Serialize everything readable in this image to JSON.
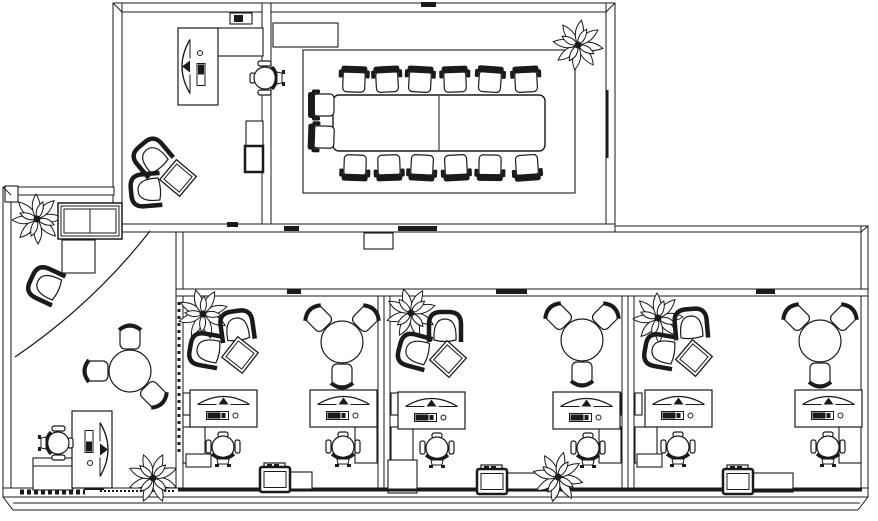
{
  "canvas": {
    "width": 878,
    "height": 521,
    "background": "#ffffff",
    "line_color": "#1a1a1a"
  },
  "floorplan": {
    "walls": [
      {
        "name": "top-wall",
        "x": 113,
        "y": 3,
        "w": 502,
        "h": 9
      },
      {
        "name": "private-office-left-wall",
        "x": 113,
        "y": 3,
        "w": 9,
        "h": 229
      },
      {
        "name": "office-conference-divider-wall",
        "x": 262,
        "y": 3,
        "w": 9,
        "h": 229
      },
      {
        "name": "conference-right-wall",
        "x": 606,
        "y": 3,
        "w": 9,
        "h": 229
      },
      {
        "name": "corridor-top-wall-left",
        "x": 121,
        "y": 224,
        "w": 494,
        "h": 8
      },
      {
        "name": "reception-top-wall",
        "x": 3,
        "y": 187,
        "w": 111,
        "h": 8
      },
      {
        "name": "reception-left-wall",
        "x": 3,
        "y": 187,
        "w": 8,
        "h": 310
      },
      {
        "name": "reception-right-wall",
        "x": 176,
        "y": 232,
        "w": 7,
        "h": 265
      },
      {
        "name": "corridor-top-wall-right",
        "x": 615,
        "y": 226,
        "w": 253,
        "h": 6
      },
      {
        "name": "building-right-wall",
        "x": 861,
        "y": 226,
        "w": 7,
        "h": 271
      },
      {
        "name": "workbay-top-wall",
        "x": 176,
        "y": 289,
        "w": 692,
        "h": 7
      },
      {
        "name": "workbay-divider-wall-1",
        "x": 378,
        "y": 296,
        "w": 12,
        "h": 192
      },
      {
        "name": "workbay-divider-wall-2",
        "x": 622,
        "y": 296,
        "w": 12,
        "h": 192
      },
      {
        "name": "building-bottom-wall",
        "x": 3,
        "y": 488,
        "w": 865,
        "h": 9
      }
    ],
    "wall_lines": [
      {
        "name": "miter-top-left",
        "x1": 113,
        "y1": 3,
        "x2": 122,
        "y2": 12
      },
      {
        "name": "miter-conference-top-right",
        "x1": 615,
        "y1": 3,
        "x2": 606,
        "y2": 12
      },
      {
        "name": "miter-reception-corner",
        "x1": 3,
        "y1": 187,
        "x2": 11,
        "y2": 195
      },
      {
        "name": "miter-corridor-right",
        "x1": 868,
        "y1": 226,
        "x2": 861,
        "y2": 232
      },
      {
        "name": "miter-bottom-left",
        "x1": 3,
        "y1": 497,
        "x2": 13,
        "y2": 510
      },
      {
        "name": "miter-bottom-right",
        "x1": 868,
        "y1": 497,
        "x2": 858,
        "y2": 510
      },
      {
        "name": "apron-line-1",
        "x1": 13,
        "y1": 503,
        "x2": 860,
        "y2": 503
      },
      {
        "name": "apron-line-2",
        "x1": 13,
        "y1": 510,
        "x2": 858,
        "y2": 510
      },
      {
        "name": "divider-1-centerline",
        "x1": 384,
        "y1": 296,
        "x2": 384,
        "y2": 488
      },
      {
        "name": "divider-2-centerline",
        "x1": 628,
        "y1": 296,
        "x2": 628,
        "y2": 488
      },
      {
        "name": "bottom-wall-heavy-edge",
        "x1": 178,
        "y1": 490,
        "x2": 862,
        "y2": 490,
        "w": 3
      },
      {
        "name": "reception-threshold-dashed",
        "x1": 20,
        "y1": 492,
        "x2": 85,
        "y2": 492,
        "w": 5,
        "dash": "4 3"
      },
      {
        "name": "reception-bottom-dotted",
        "x1": 100,
        "y1": 491,
        "x2": 174,
        "y2": 491,
        "w": 2,
        "dash": "2 2"
      },
      {
        "name": "reception-wall-glазing-dash",
        "x1": 179,
        "y1": 302,
        "x2": 179,
        "y2": 455,
        "w": 3,
        "dash": "3 4"
      },
      {
        "name": "conference-window-strip",
        "x1": 607,
        "y1": 90,
        "x2": 607,
        "y2": 158,
        "w": 3
      },
      {
        "name": "conference-table-centerline",
        "x1": 439,
        "y1": 96,
        "x2": 439,
        "y2": 150
      },
      {
        "name": "reception-counter-inner-line",
        "x1": 33,
        "y1": 466,
        "x2": 73,
        "y2": 466
      }
    ],
    "furniture_rects": [
      {
        "name": "conference-room-inner-border",
        "x": 303,
        "y": 50,
        "w": 272,
        "h": 143
      },
      {
        "name": "conference-table",
        "x": 333,
        "y": 95,
        "w": 212,
        "h": 56,
        "rx": 6,
        "sw": 1.4
      },
      {
        "name": "conference-credenza",
        "x": 273,
        "y": 23,
        "w": 65,
        "h": 24
      },
      {
        "name": "office-credenza",
        "x": 217,
        "y": 28,
        "w": 46,
        "h": 28
      },
      {
        "name": "office-phone-tray",
        "x": 230,
        "y": 13,
        "w": 22,
        "h": 11
      },
      {
        "name": "office-file-cabinet-top",
        "x": 246,
        "y": 121,
        "w": 17,
        "h": 25
      },
      {
        "name": "office-file-cabinet-bottom",
        "x": 245,
        "y": 146,
        "w": 18,
        "h": 26,
        "sw": 2.5
      },
      {
        "name": "reception-square-table",
        "x": 62,
        "y": 240,
        "w": 33,
        "h": 33
      },
      {
        "name": "reception-counter",
        "x": 33,
        "y": 458,
        "w": 40,
        "h": 32
      },
      {
        "name": "reception-mini-printer",
        "x": 85,
        "y": 477,
        "w": 18,
        "h": 12,
        "sw": 2
      },
      {
        "name": "corridor-sign",
        "x": 364,
        "y": 233,
        "w": 29,
        "h": 16
      },
      {
        "name": "corner-post",
        "x": 5,
        "y": 186,
        "w": 13,
        "h": 16
      },
      {
        "name": "wall-shelf",
        "x": 183,
        "y": 393,
        "w": 7,
        "h": 22
      },
      {
        "name": "wall-shelf",
        "x": 371,
        "y": 393,
        "w": 7,
        "h": 22
      },
      {
        "name": "wall-shelf",
        "x": 391,
        "y": 393,
        "w": 7,
        "h": 22
      },
      {
        "name": "wall-shelf",
        "x": 614,
        "y": 393,
        "w": 7,
        "h": 22
      },
      {
        "name": "wall-shelf",
        "x": 635,
        "y": 393,
        "w": 7,
        "h": 22
      },
      {
        "name": "wall-shelf",
        "x": 854,
        "y": 393,
        "w": 7,
        "h": 22
      },
      {
        "name": "desk-return",
        "x": 183,
        "y": 427,
        "w": 22,
        "h": 36
      },
      {
        "name": "desk-return",
        "x": 355,
        "y": 427,
        "w": 22,
        "h": 36
      },
      {
        "name": "desk-return",
        "x": 391,
        "y": 427,
        "w": 22,
        "h": 36
      },
      {
        "name": "desk-return",
        "x": 599,
        "y": 427,
        "w": 22,
        "h": 36
      },
      {
        "name": "desk-return",
        "x": 635,
        "y": 427,
        "w": 22,
        "h": 36
      },
      {
        "name": "desk-return",
        "x": 839,
        "y": 427,
        "w": 22,
        "h": 36
      },
      {
        "name": "low-cabinet",
        "x": 186,
        "y": 454,
        "w": 25,
        "h": 13
      },
      {
        "name": "low-cabinet",
        "x": 388,
        "y": 460,
        "w": 29,
        "h": 33
      },
      {
        "name": "low-cabinet",
        "x": 637,
        "y": 454,
        "w": 25,
        "h": 13
      },
      {
        "name": "printer-stand",
        "x": 262,
        "y": 472,
        "w": 50,
        "h": 19
      },
      {
        "name": "printer-stand",
        "x": 479,
        "y": 473,
        "w": 81,
        "h": 18
      },
      {
        "name": "printer-stand",
        "x": 725,
        "y": 473,
        "w": 68,
        "h": 19
      }
    ],
    "dark_marks": [
      {
        "name": "door-threshold",
        "x": 227,
        "y": 222,
        "w": 11,
        "h": 5
      },
      {
        "name": "door-threshold",
        "x": 284,
        "y": 226,
        "w": 15,
        "h": 5
      },
      {
        "name": "door-leaf-conference",
        "x": 398,
        "y": 226,
        "w": 39,
        "h": 5
      },
      {
        "name": "door-threshold-top",
        "x": 421,
        "y": 2,
        "w": 15,
        "h": 5
      },
      {
        "name": "door-leaf-bay-1",
        "x": 287,
        "y": 289,
        "w": 14,
        "h": 5
      },
      {
        "name": "door-leaf-bay-2",
        "x": 496,
        "y": 289,
        "w": 31,
        "h": 5
      },
      {
        "name": "door-leaf-bay-3",
        "x": 756,
        "y": 289,
        "w": 19,
        "h": 5
      },
      {
        "name": "phone-handset",
        "x": 234,
        "y": 15,
        "w": 9,
        "h": 7
      }
    ],
    "paths": [
      {
        "name": "door-swing-arc",
        "d": "M150 231 Q93 304 15 357"
      }
    ],
    "furniture": [
      {
        "name": "plant-conference",
        "type": "plant",
        "cx": 578,
        "cy": 45,
        "rot": 10
      },
      {
        "name": "plant-reception-top",
        "type": "plant",
        "cx": 37,
        "cy": 219,
        "rot": 0
      },
      {
        "name": "plant-reception-bottom",
        "type": "plant",
        "cx": 153,
        "cy": 478,
        "rot": 25
      },
      {
        "name": "plant-bay-1",
        "type": "plant",
        "cx": 203,
        "cy": 314,
        "rot": -15
      },
      {
        "name": "plant-bay-2",
        "type": "plant",
        "cx": 411,
        "cy": 313,
        "rot": 30
      },
      {
        "name": "plant-bay-3",
        "type": "plant",
        "cx": 658,
        "cy": 318,
        "rot": 0
      },
      {
        "name": "plant-bay-2-bottom",
        "type": "plant",
        "cx": 558,
        "cy": 477,
        "rot": 15
      },
      {
        "name": "lounge-armchair",
        "type": "armchair",
        "cx": 152,
        "cy": 157,
        "rot": -40
      },
      {
        "name": "lounge-armchair",
        "type": "armchair",
        "cx": 147,
        "cy": 190,
        "rot": -95
      },
      {
        "name": "lounge-armchair",
        "type": "armchair",
        "cx": 46,
        "cy": 285,
        "rot": -65
      },
      {
        "name": "lounge-armchair",
        "type": "armchair",
        "cx": 237,
        "cy": 327,
        "rot": -8
      },
      {
        "name": "lounge-armchair",
        "type": "armchair",
        "cx": 206,
        "cy": 350,
        "rot": -80
      },
      {
        "name": "lounge-armchair",
        "type": "armchair",
        "cx": 445,
        "cy": 328,
        "rot": 0
      },
      {
        "name": "lounge-armchair",
        "type": "armchair",
        "cx": 415,
        "cy": 351,
        "rot": -75
      },
      {
        "name": "lounge-armchair",
        "type": "armchair",
        "cx": 691,
        "cy": 325,
        "rot": -5
      },
      {
        "name": "lounge-armchair",
        "type": "armchair",
        "cx": 661,
        "cy": 351,
        "rot": -80
      },
      {
        "name": "side-table-diamond",
        "type": "diamond",
        "cx": 178,
        "cy": 178,
        "rot": 40
      },
      {
        "name": "side-table-diamond",
        "type": "diamond",
        "cx": 240,
        "cy": 355,
        "rot": 38
      },
      {
        "name": "side-table-diamond",
        "type": "diamond",
        "cx": 448,
        "cy": 359,
        "rot": 42
      },
      {
        "name": "side-table-diamond",
        "type": "diamond",
        "cx": 694,
        "cy": 358,
        "rot": 40
      },
      {
        "name": "office-desk-computer",
        "type": "vdesk",
        "cx": 198,
        "cy": 66.5,
        "rot": 0
      },
      {
        "name": "reception-desk-computer",
        "type": "vdesk",
        "cx": 92,
        "cy": 449.5,
        "rot": 180
      },
      {
        "name": "workstation-desk",
        "type": "desk",
        "cx": 223.5,
        "cy": 408.5,
        "rot": 0
      },
      {
        "name": "workstation-desk",
        "type": "desk",
        "cx": 343.5,
        "cy": 408.5,
        "rot": 0
      },
      {
        "name": "workstation-desk",
        "type": "desk",
        "cx": 431.5,
        "cy": 410.5,
        "rot": 0
      },
      {
        "name": "workstation-desk",
        "type": "desk",
        "cx": 586.5,
        "cy": 410.5,
        "rot": 0
      },
      {
        "name": "workstation-desk",
        "type": "desk",
        "cx": 678.5,
        "cy": 408.5,
        "rot": 0
      },
      {
        "name": "workstation-desk",
        "type": "desk",
        "cx": 828.5,
        "cy": 408.5,
        "rot": 0
      },
      {
        "name": "office-task-chair",
        "type": "taskchair",
        "cx": 265,
        "cy": 78,
        "rot": -90
      },
      {
        "name": "reception-task-chair",
        "type": "taskchair",
        "cx": 58,
        "cy": 443,
        "rot": 90
      },
      {
        "name": "workstation-task-chair",
        "type": "taskchair",
        "cx": 223,
        "cy": 447,
        "rot": 0
      },
      {
        "name": "workstation-task-chair",
        "type": "taskchair",
        "cx": 343,
        "cy": 447,
        "rot": 0
      },
      {
        "name": "workstation-task-chair",
        "type": "taskchair",
        "cx": 437,
        "cy": 448,
        "rot": 0
      },
      {
        "name": "workstation-task-chair",
        "type": "taskchair",
        "cx": 588,
        "cy": 448,
        "rot": 0
      },
      {
        "name": "workstation-task-chair",
        "type": "taskchair",
        "cx": 678,
        "cy": 447,
        "rot": 0
      },
      {
        "name": "workstation-task-chair",
        "type": "taskchair",
        "cx": 828,
        "cy": 447,
        "rot": 0
      },
      {
        "name": "conference-chair",
        "type": "cchair",
        "cx": 354,
        "cy": 80,
        "rot": 2
      },
      {
        "name": "conference-chair",
        "type": "cchair",
        "cx": 387,
        "cy": 80,
        "rot": -3
      },
      {
        "name": "conference-chair",
        "type": "cchair",
        "cx": 420,
        "cy": 80,
        "rot": 3
      },
      {
        "name": "conference-chair",
        "type": "cchair",
        "cx": 455,
        "cy": 80,
        "rot": -2
      },
      {
        "name": "conference-chair",
        "type": "cchair",
        "cx": 490,
        "cy": 80,
        "rot": 4
      },
      {
        "name": "conference-chair",
        "type": "cchair",
        "cx": 526,
        "cy": 80,
        "rot": -3
      },
      {
        "name": "conference-chair",
        "type": "cchair",
        "cx": 355,
        "cy": 167,
        "rot": 182
      },
      {
        "name": "conference-chair",
        "type": "cchair",
        "cx": 389,
        "cy": 167,
        "rot": 178
      },
      {
        "name": "conference-chair",
        "type": "cchair",
        "cx": 422,
        "cy": 167,
        "rot": 183
      },
      {
        "name": "conference-chair",
        "type": "cchair",
        "cx": 456,
        "cy": 167,
        "rot": 177
      },
      {
        "name": "conference-chair",
        "type": "cchair",
        "cx": 490,
        "cy": 167,
        "rot": 181
      },
      {
        "name": "conference-chair",
        "type": "cchair",
        "cx": 527,
        "cy": 167,
        "rot": 176
      },
      {
        "name": "conference-chair",
        "type": "cchair",
        "cx": 322,
        "cy": 105,
        "rot": -90
      },
      {
        "name": "conference-chair",
        "type": "cchair",
        "cx": 322,
        "cy": 137,
        "rot": -88
      },
      {
        "name": "printer",
        "type": "printer",
        "cx": 275,
        "cy": 479.5,
        "rot": 0
      },
      {
        "name": "printer",
        "type": "printer",
        "cx": 492,
        "cy": 481.5,
        "rot": 0
      },
      {
        "name": "printer",
        "type": "printer",
        "cx": 738,
        "cy": 481.5,
        "rot": 0
      },
      {
        "name": "window-unit",
        "type": "window",
        "cx": 90,
        "cy": 221,
        "rot": 0
      }
    ],
    "round_tables": [
      {
        "name": "round-table-reception",
        "cx": 130,
        "cy": 371,
        "r": 21,
        "chairs": [
          270,
          180,
          45
        ]
      },
      {
        "name": "round-table-bay-1",
        "cx": 342,
        "cy": 342,
        "r": 21,
        "chairs": [
          225,
          315,
          90
        ]
      },
      {
        "name": "round-table-bay-2",
        "cx": 582,
        "cy": 340,
        "r": 21,
        "chairs": [
          225,
          315,
          90
        ]
      },
      {
        "name": "round-table-bay-3",
        "cx": 820,
        "cy": 341,
        "r": 21,
        "chairs": [
          225,
          315,
          90
        ]
      }
    ]
  }
}
